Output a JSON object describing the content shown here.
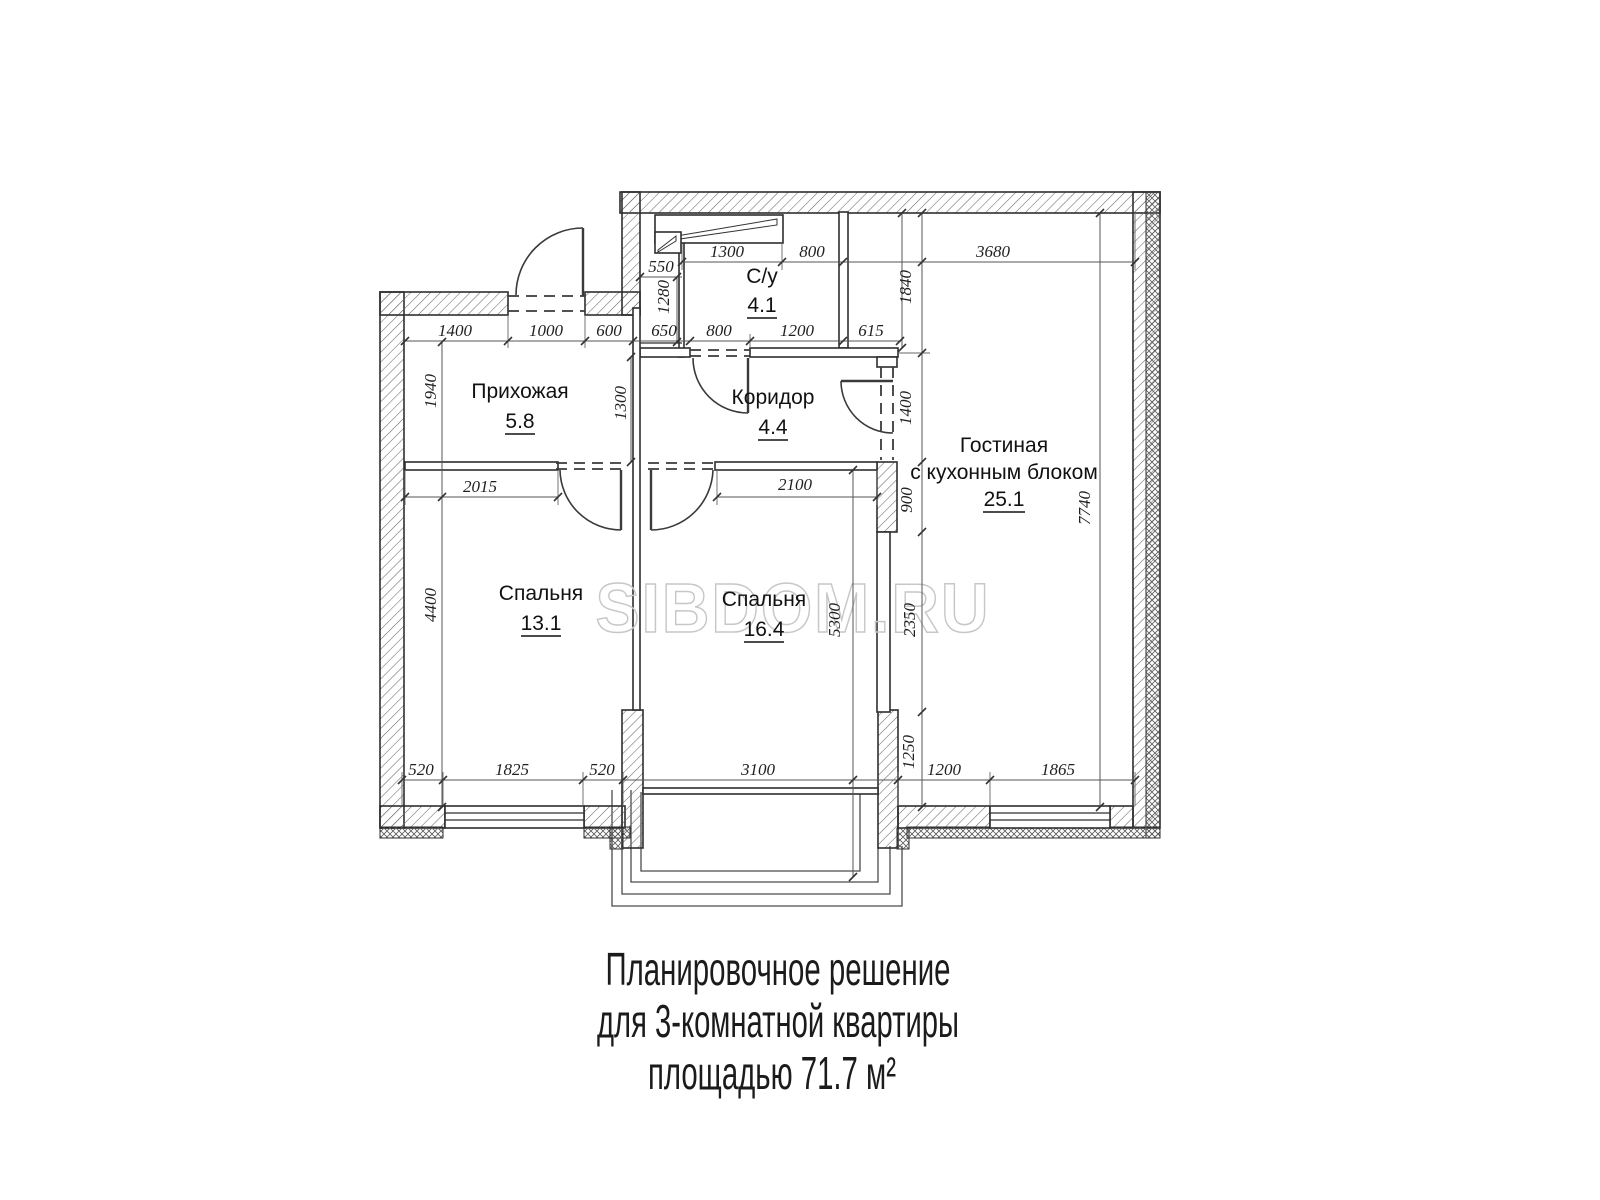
{
  "watermark": "SIBDOM.RU",
  "caption": {
    "line1": "Планировочное решение",
    "line2": "для 3-комнатной квартиры",
    "line3": "площадью 71.7 м²"
  },
  "rooms": {
    "bathroom": {
      "name": "С/у",
      "area": "4.1"
    },
    "hallway": {
      "name": "Прихожая",
      "area": "5.8"
    },
    "corridor": {
      "name": "Коридор",
      "area": "4.4"
    },
    "living": {
      "name_line1": "Гостиная",
      "name_line2": "с кухонным блоком",
      "area": "25.1"
    },
    "bedroom1": {
      "name": "Спальня",
      "area": "13.1"
    },
    "bedroom2": {
      "name": "Спальня",
      "area": "16.4"
    }
  },
  "dims": {
    "d1400a": "1400",
    "d1000": "1000",
    "d600": "600",
    "d550": "550",
    "d1300a": "1300",
    "d800a": "800",
    "d3680": "3680",
    "d1280": "1280",
    "d650": "650",
    "d800b": "800",
    "d1200a": "1200",
    "d615": "615",
    "d1840": "1840",
    "d1940": "1940",
    "d1300b": "1300",
    "d1400b": "1400",
    "d2015": "2015",
    "d2100": "2100",
    "d900": "900",
    "d4400": "4400",
    "d5300": "5300",
    "d2350": "2350",
    "d7740": "7740",
    "d520a": "520",
    "d1825": "1825",
    "d520b": "520",
    "d3100": "3100",
    "d1250": "1250",
    "d1200b": "1200",
    "d1865": "1865"
  }
}
